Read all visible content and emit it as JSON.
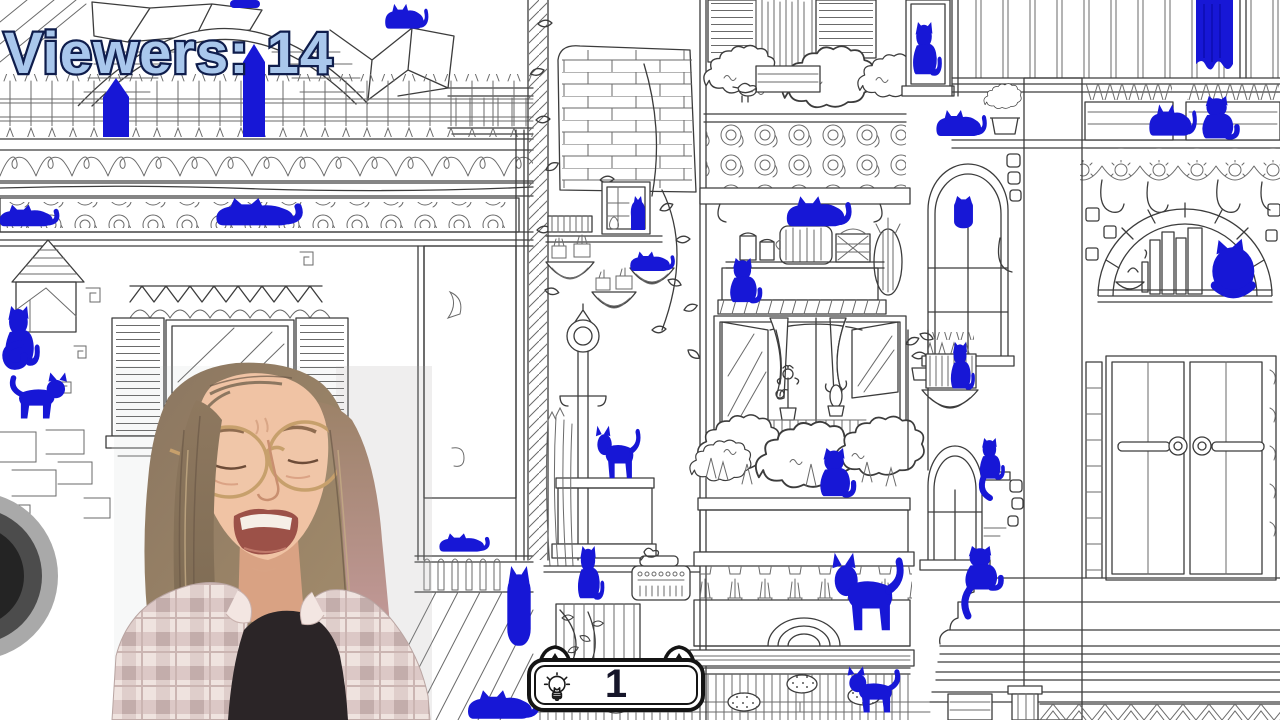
{
  "stream_overlay": {
    "viewers_text": "Viewers: 14"
  },
  "game_hud": {
    "hint_count": "1",
    "hint_icon": "lightbulb-icon"
  },
  "scene": {
    "hidden_cat_color": "#1717d6",
    "line_color": "#3c3c3c",
    "viewers_text_fill": "#a9c7ec",
    "viewers_text_outline": "#0f1d4c"
  }
}
